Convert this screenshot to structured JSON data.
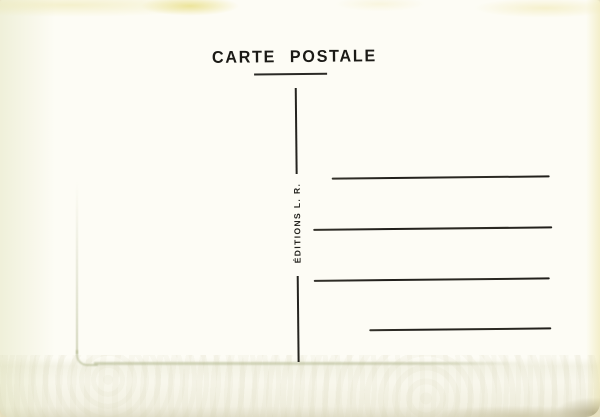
{
  "card": {
    "title": "CARTE POSTALE",
    "publisher_credit": "ÉDITIONS L. R.",
    "address_lines_count": 4
  },
  "colors": {
    "paper": "#fdfcf5",
    "ink": "#1d1c18",
    "emboss_ridge": "#acb288",
    "edge_tint": "#eee6a8"
  }
}
